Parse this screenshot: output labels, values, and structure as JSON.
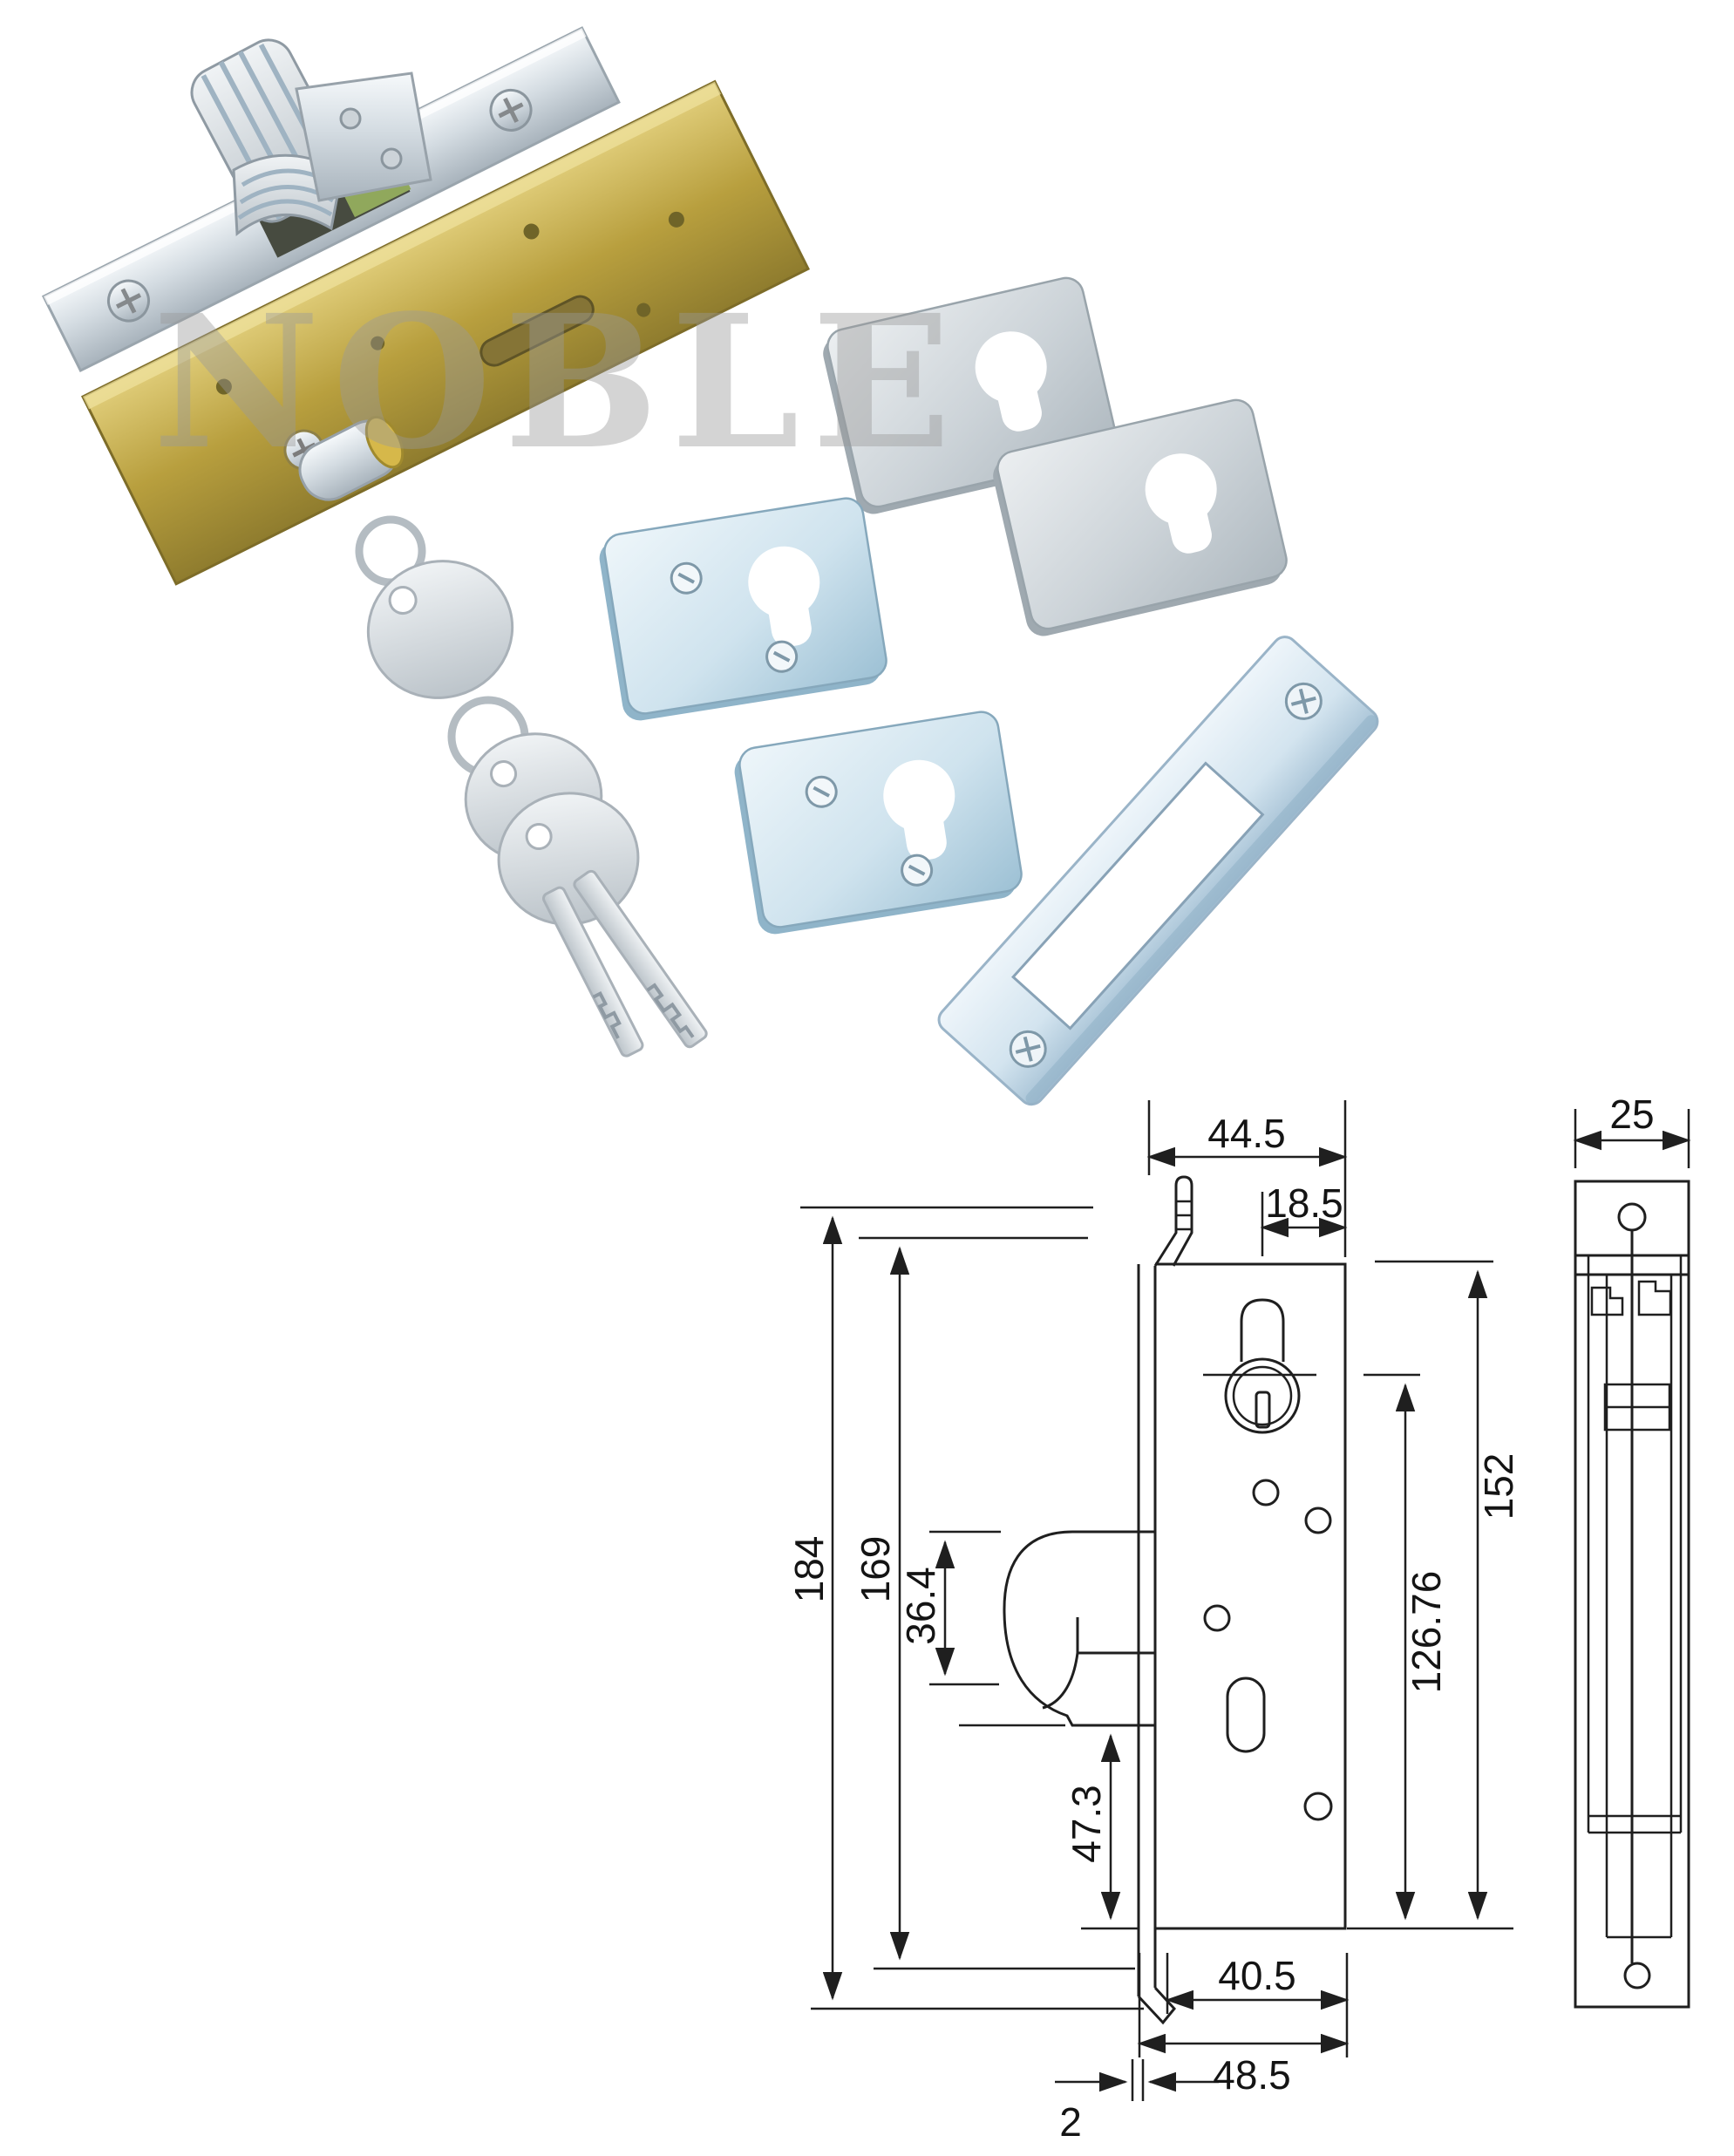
{
  "watermark": {
    "text": "NOBLE"
  },
  "drawing": {
    "front_view": {
      "width_top": "44.5",
      "cylinder_to_edge": "18.5",
      "faceplate_height": "184",
      "case_inner_height": "169",
      "hook_height": "36.4",
      "hook_to_bottom": "47.3",
      "cylinder_axis_to_bottom": "126.76",
      "case_height": "152",
      "width_bottom_inner": "40.5",
      "width_bottom_overall": "48.5",
      "faceplate_thickness": "2"
    },
    "side_view": {
      "width": "25"
    }
  },
  "colors": {
    "background": "#ffffff",
    "brass_case": "#b89f3e",
    "silver_faceplate": "#c2ccd3",
    "blue_escutcheon": "#c3dcea",
    "gray_escutcheon": "#ccd3d8",
    "drawing_line": "#1f1f1f",
    "watermark": "#9a9a9a"
  }
}
